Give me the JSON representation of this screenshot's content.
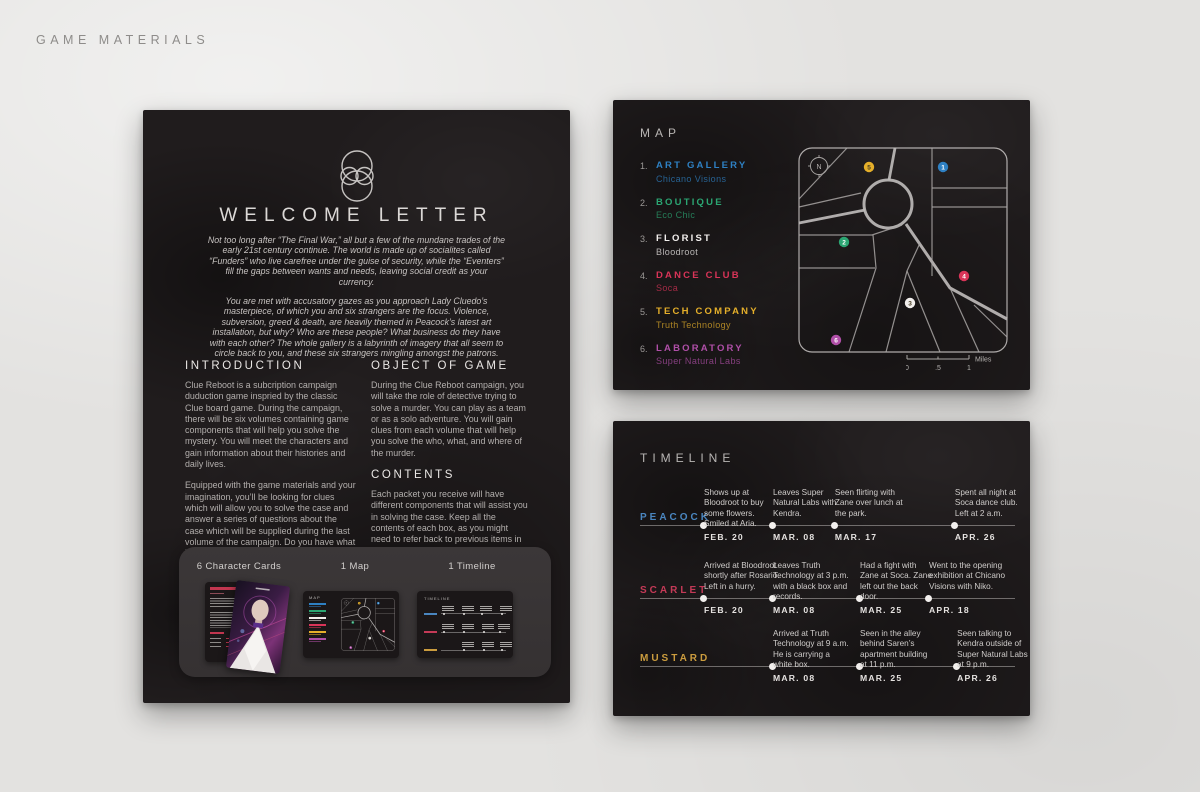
{
  "page": {
    "title": "GAME MATERIALS"
  },
  "letter": {
    "title": "WELCOME LETTER",
    "intro": [
      "Not too long after “The Final War,” all but a few of the mundane trades of the early 21st century continue. The world is made up of socialites called “Funders” who live carefree under the guise of security, while the “Eventers” fill the gaps between wants and needs, leaving social credit as your currency.",
      "You are met with accusatory gazes as you approach Lady Cluedo’s masterpiece, of which you and six strangers are the focus. Violence, subversion, greed & death, are heavily themed in Peacock’s latest art installation, but why? Who are these people? What business do they have with each other? The whole gallery is a labyrinth of imagery that all seem to circle back to you, and these six strangers mingling amongst the patrons."
    ],
    "sections": {
      "introduction": {
        "heading": "INTRODUCTION",
        "paragraphs": [
          "Clue Reboot is a subcription campaign duduction game inspried by the classic Clue board game. During the campaign, there will be six volumes containing game components that will help you solve the mystery.  You will meet the characters and gain information about their histories and daily lives.",
          "Equipped with the game materials and your imagination, you’ll be looking for clues which will allow you to solve the case and answer a series of questions about the case which will be supplied during the last volume of the campaign. Do you have what it takes?"
        ]
      },
      "object_of_game": {
        "heading": "OBJECT OF GAME",
        "paragraphs": [
          "During the Clue Reboot campaign,  you will take the role of detective trying to solve a murder. You can play as a team or as a solo adventure. You will gain clues from each volume that will help you solve the who, what, and where of the murder."
        ]
      },
      "contents": {
        "heading": "CONTENTS",
        "paragraphs": [
          "Each packet you receive will have different components that will assist you in solving the case.  Keep all the contents of each box, as you might need to refer back to previous items in order to get all the clues."
        ]
      }
    },
    "components": {
      "cards": "6 Character Cards",
      "map": "1 Map",
      "timeline": "1 Timeline"
    }
  },
  "map": {
    "title": "MAP",
    "compass": "N",
    "legend": [
      {
        "n": "1.",
        "pin": "1",
        "label": "ART GALLERY",
        "name": "Chicano Visions",
        "color": "#2e80c3"
      },
      {
        "n": "2.",
        "pin": "2",
        "label": "BOUTIQUE",
        "name": "Eco Chic",
        "color": "#2ba572"
      },
      {
        "n": "3.",
        "pin": "3",
        "label": "FLORIST",
        "name": "Bloodroot",
        "color": "#f2efed"
      },
      {
        "n": "4.",
        "pin": "4",
        "label": "DANCE CLUB",
        "name": "Soca",
        "color": "#d93458"
      },
      {
        "n": "5.",
        "pin": "5",
        "label": "TECH COMPANY",
        "name": "Truth Technology",
        "color": "#e5af2a"
      },
      {
        "n": "6.",
        "pin": "6",
        "label": "LABORATORY",
        "name": "Super Natural Labs",
        "color": "#b04fa8"
      }
    ],
    "scale": {
      "t0": "0",
      "t1": ".5",
      "t2": "1",
      "unit": "Miles"
    }
  },
  "timeline": {
    "title": "TIMELINE",
    "rows": [
      {
        "name": "PEACOCK",
        "color": "#4a86c0",
        "events": [
          {
            "text": "Shows up at Bloodroot to buy some flowers. Smiled at Aria.",
            "date": "FEB. 20"
          },
          {
            "text": "Leaves Super Natural Labs with Kendra.",
            "date": "MAR. 08"
          },
          {
            "text": "Seen flirting with Zane over lunch at the park.",
            "date": "MAR. 17"
          },
          {
            "text": "Spent all night at Soca dance club. Left at 2 a.m.",
            "date": "APR. 26"
          }
        ]
      },
      {
        "name": "SCARLET",
        "color": "#c53a57",
        "events": [
          {
            "text": "Arrived at Bloodroot shortly after Rosario. Left in a hurry.",
            "date": "FEB. 20"
          },
          {
            "text": "Leaves Truth Technology at 3 p.m. with a black box and records.",
            "date": "MAR. 08"
          },
          {
            "text": "Had a fight with Zane at Soca. Zane left out the back door.",
            "date": "MAR. 25"
          },
          {
            "text": "Went to the opening exhibition at Chicano Visions with Niko.",
            "date": "APR. 18"
          }
        ]
      },
      {
        "name": "MUSTARD",
        "color": "#cb9c3e",
        "events": [
          {
            "text": "Arrived at Truth Technology at 9 a.m.  He is carrying a white box.",
            "date": "MAR. 08"
          },
          {
            "text": "Seen in the alley behind Saren’s apartment building at 11 p.m.",
            "date": "MAR. 25"
          },
          {
            "text": "Seen talking to Kendra outside of Super Natural Labs at 9 p.m.",
            "date": "APR. 26"
          }
        ]
      }
    ]
  }
}
